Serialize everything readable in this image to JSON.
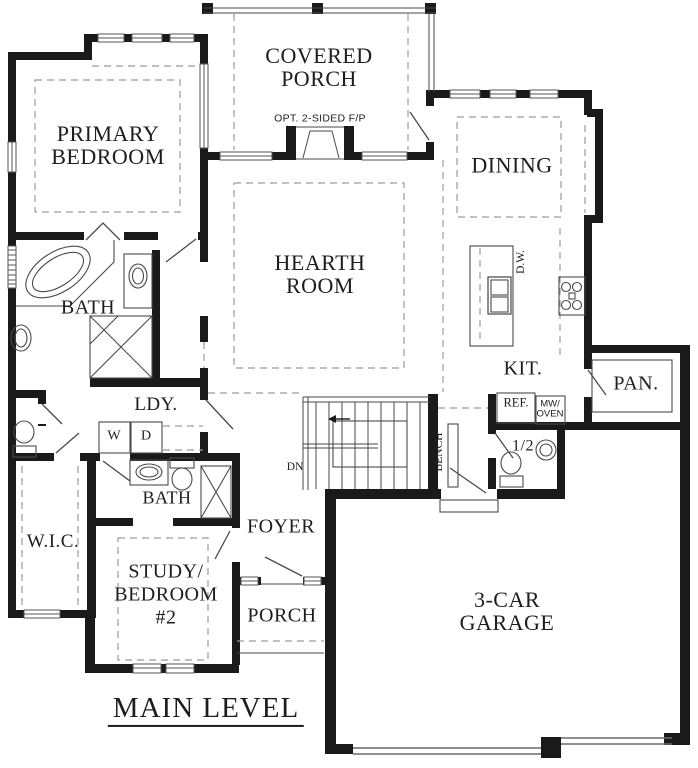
{
  "plan": {
    "title": "MAIN LEVEL",
    "rooms": {
      "covered_porch": {
        "line1": "COVERED",
        "line2": "PORCH"
      },
      "fireplace_note": "OPT. 2-SIDED F/P",
      "primary_bedroom": {
        "line1": "PRIMARY",
        "line2": "BEDROOM"
      },
      "dining": "DINING",
      "hearth_room": {
        "line1": "HEARTH",
        "line2": "ROOM"
      },
      "primary_bath": "BATH",
      "laundry": "LDY.",
      "walk_in_closet": "W.I.C.",
      "bath_2": "BATH",
      "study": {
        "line1": "STUDY/",
        "line2": "BEDROOM",
        "line3": "#2"
      },
      "foyer": "FOYER",
      "porch": "PORCH",
      "garage": {
        "line1": "3-CAR",
        "line2": "GARAGE"
      },
      "kitchen": "KIT.",
      "pantry": "PAN.",
      "half_bath": "1/2"
    },
    "fixtures": {
      "washer": "W",
      "dryer": "D",
      "dishwasher": "D.W.",
      "refrigerator": "REF.",
      "microwave": {
        "line1": "MW/",
        "line2": "OVEN"
      },
      "bench": "BENCH",
      "stairs_down": "DN"
    },
    "colors": {
      "wall": "#1a1a1a",
      "thin_line": "#4a4a4a",
      "dashed_line": "#9b9b9b",
      "text": "#1d1d1d",
      "background": "#ffffff"
    }
  }
}
